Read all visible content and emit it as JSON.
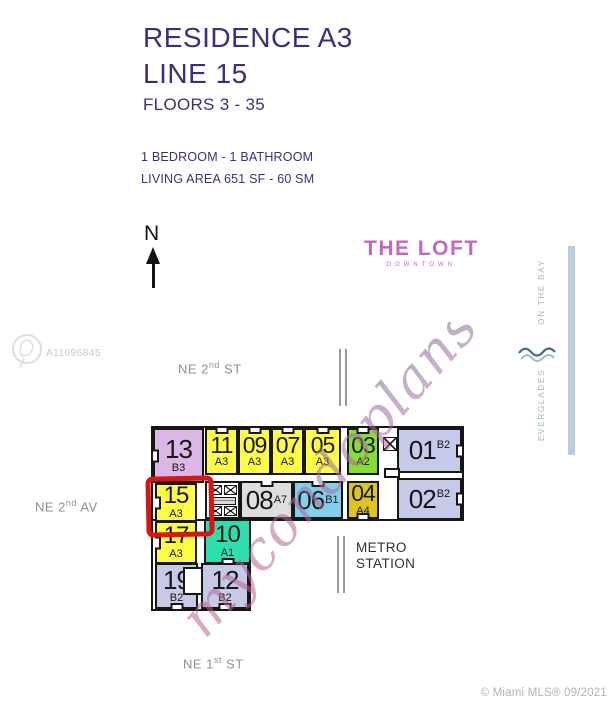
{
  "header": {
    "title_line1": "RESIDENCE A3",
    "title_line2": "LINE 15",
    "floors": "FLOORS 3 - 35",
    "spec_line1": "1 BEDROOM - 1 BATHROOM",
    "spec_line2": "LIVING AREA 651 SF - 60 SM",
    "accent_color": "#393180"
  },
  "compass": {
    "label": "N"
  },
  "logo": {
    "title": "THE LOFT",
    "subtitle": "DOWNTOWN",
    "color": "#c466c4"
  },
  "streets": {
    "top": {
      "prefix": "NE 2",
      "sup": "nd",
      "suffix": " ST"
    },
    "left": {
      "prefix": "NE 2",
      "sup": "nd",
      "suffix": " AV"
    },
    "bottom": {
      "prefix": "NE 1",
      "sup": "st",
      "suffix": " ST"
    }
  },
  "metro": {
    "label": "METRO STATION"
  },
  "plan": {
    "outline_color": "#161616",
    "highlight": {
      "unit": "15",
      "color": "#dc1410"
    },
    "units": [
      {
        "number": "13",
        "type": "B3",
        "color": "#dcb6e6",
        "x": 153,
        "y": 428,
        "w": 51,
        "h": 55,
        "layout": "stack",
        "fs": 26,
        "notch": "left"
      },
      {
        "number": "11",
        "type": "A3",
        "color": "#fdfb43",
        "x": 205,
        "y": 428,
        "w": 33,
        "h": 47,
        "layout": "stack",
        "fs": 23,
        "notch": "top"
      },
      {
        "number": "09",
        "type": "A3",
        "color": "#fdfb43",
        "x": 238,
        "y": 428,
        "w": 33,
        "h": 47,
        "layout": "stack",
        "fs": 23,
        "notch": "top"
      },
      {
        "number": "07",
        "type": "A3",
        "color": "#fdfb43",
        "x": 271,
        "y": 428,
        "w": 33,
        "h": 47,
        "layout": "stack",
        "fs": 23,
        "notch": "top"
      },
      {
        "number": "05",
        "type": "A3",
        "color": "#fdfb43",
        "x": 304,
        "y": 428,
        "w": 37,
        "h": 47,
        "layout": "stack",
        "fs": 23,
        "notch": "top"
      },
      {
        "number": "03",
        "type": "A2",
        "color": "#8adc30",
        "x": 347,
        "y": 428,
        "w": 32,
        "h": 47,
        "layout": "stack",
        "fs": 23,
        "notch": "top"
      },
      {
        "number": "01",
        "type": "B2",
        "color": "#c6cae8",
        "x": 397,
        "y": 428,
        "w": 65,
        "h": 45,
        "layout": "inline-top",
        "fs": 26,
        "notch": "right"
      },
      {
        "number": "15",
        "type": "A3",
        "color": "#fdfb43",
        "x": 155,
        "y": 483,
        "w": 42,
        "h": 39,
        "layout": "stack",
        "fs": 24,
        "notch": "left"
      },
      {
        "number": "08",
        "type": "A7",
        "color": "#dedede",
        "x": 240,
        "y": 481,
        "w": 53,
        "h": 38,
        "layout": "inline",
        "fs": 26,
        "notch": "top"
      },
      {
        "number": "06",
        "type": "B1",
        "color": "#7fd0e8",
        "x": 293,
        "y": 481,
        "w": 50,
        "h": 38,
        "layout": "inline",
        "fs": 26,
        "notch": "top"
      },
      {
        "number": "04",
        "type": "A4",
        "color": "#ddc51e",
        "x": 347,
        "y": 481,
        "w": 32,
        "h": 38,
        "layout": "stack",
        "fs": 23,
        "notch": "bottom"
      },
      {
        "number": "02",
        "type": "B2",
        "color": "#c6cae8",
        "x": 397,
        "y": 478,
        "w": 65,
        "h": 42,
        "layout": "inline-top",
        "fs": 26,
        "notch": "right"
      },
      {
        "number": "17",
        "type": "A3",
        "color": "#fdfb43",
        "x": 155,
        "y": 521,
        "w": 42,
        "h": 43,
        "layout": "stack",
        "fs": 24,
        "notch": "left"
      },
      {
        "number": "10",
        "type": "A1",
        "color": "#2cdfae",
        "x": 204,
        "y": 519,
        "w": 47,
        "h": 45,
        "layout": "stack",
        "fs": 24,
        "notch": "bottom"
      },
      {
        "number": "19",
        "type": "B2",
        "color": "#c6cae8",
        "x": 155,
        "y": 563,
        "w": 43,
        "h": 46,
        "layout": "stack",
        "fs": 26,
        "notch": "bottom"
      },
      {
        "number": "12",
        "type": "B2",
        "color": "#c6cae8",
        "x": 201,
        "y": 563,
        "w": 48,
        "h": 46,
        "layout": "stack",
        "fs": 26,
        "notch": "bottom"
      }
    ],
    "core": {
      "x": 205,
      "y": 481,
      "w": 35,
      "h": 38
    },
    "single_elevator": {
      "x": 383,
      "y": 437,
      "w": 14,
      "h": 14
    },
    "door_tabs": [
      {
        "x": 384,
        "y": 468,
        "w": 16,
        "h": 10
      },
      {
        "x": 183,
        "y": 567,
        "w": 20,
        "h": 28
      }
    ]
  },
  "watermarks": {
    "script": {
      "text": "mycondoplans"
    },
    "mls_id": "A11096845",
    "side": {
      "line1": "EVERGLADES",
      "line2": "ON THE BAY",
      "color": "#9fb6c0",
      "bar_color": "#b9cedb"
    }
  },
  "footer": {
    "credit": "© Miami MLS® 09/2021"
  }
}
